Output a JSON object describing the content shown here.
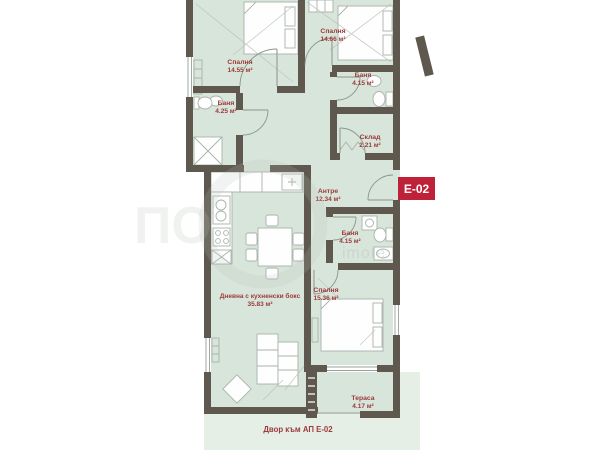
{
  "badge": {
    "label": "E-02",
    "color": "#bf2138"
  },
  "yard": {
    "label": "Двор към АП Е-02"
  },
  "watermark": {
    "big": "ПО",
    "small": "imote"
  },
  "rooms": [
    {
      "id": "bedroom-1",
      "name": "Спалня",
      "area": "14.55 м²"
    },
    {
      "id": "bedroom-2",
      "name": "Спалня",
      "area": "14.66 м²"
    },
    {
      "id": "bathroom-1",
      "name": "Баня",
      "area": "4.15 м²"
    },
    {
      "id": "bathroom-2",
      "name": "Баня",
      "area": "4.25 м²"
    },
    {
      "id": "storage",
      "name": "Склад",
      "area": "2.21 м²"
    },
    {
      "id": "hallway",
      "name": "Антре",
      "area": "12.34 м²"
    },
    {
      "id": "bathroom-3",
      "name": "Баня",
      "area": "4.15 м²"
    },
    {
      "id": "living",
      "name": "Дневна с кухненски бокс",
      "area": "35.83 м²"
    },
    {
      "id": "bedroom-3",
      "name": "Спалня",
      "area": "15.36 м²"
    },
    {
      "id": "terrace",
      "name": "Тераса",
      "area": "4.17 м²"
    }
  ],
  "colors": {
    "wall": "#5e584e",
    "floor": "#d8e5da",
    "yard": "#e5efe6",
    "label": "#9c3a3a",
    "badge": "#bf2138",
    "furn": "#a9b3aa",
    "line": "#8b948c"
  }
}
